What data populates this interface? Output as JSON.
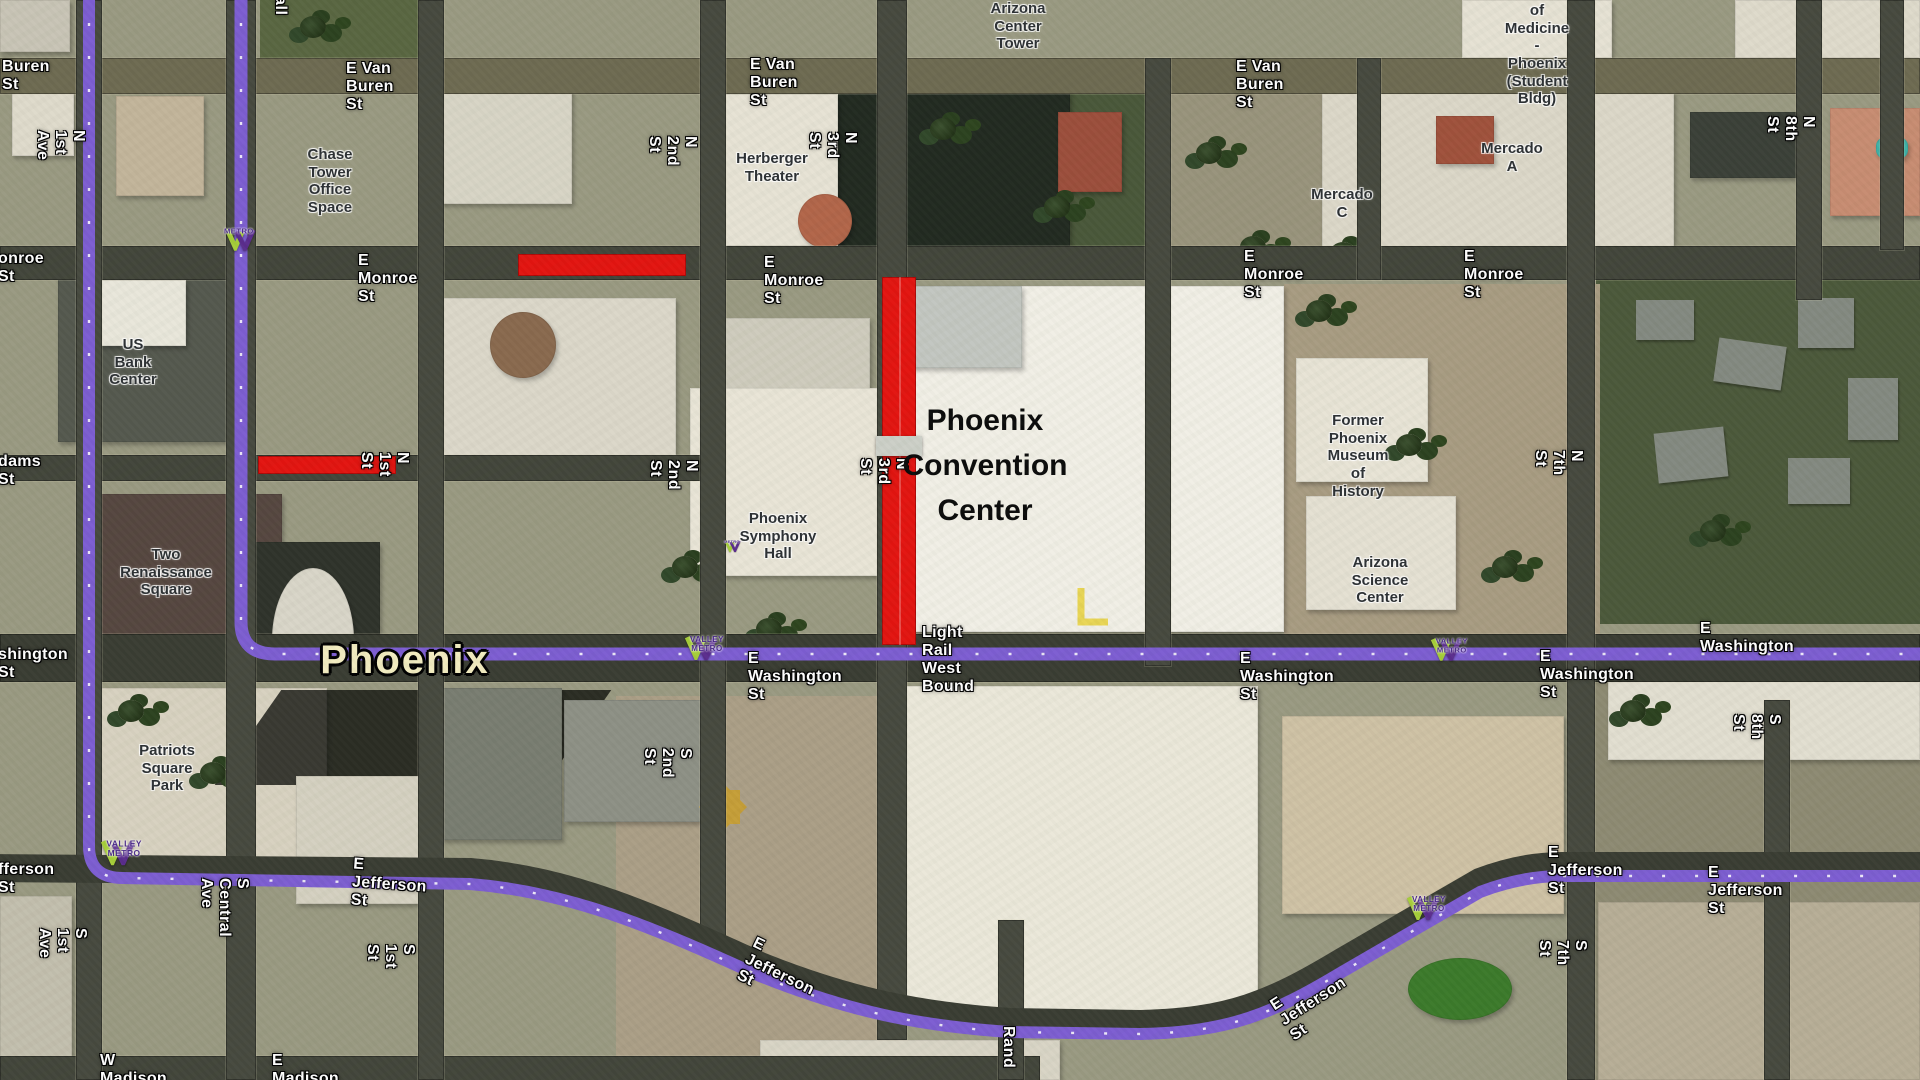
{
  "map": {
    "title_city_label": "Phoenix",
    "convention_center_label": "Phoenix\nConvention\nCenter",
    "colors": {
      "light_rail_purple": "#7d5ed2",
      "road_closure_red": "#e31511",
      "city_label_cream": "#f2ecc0",
      "metro_logo_green": "#a6ce39",
      "metro_logo_purple": "#5b2d8e"
    },
    "street_labels": [
      {
        "t": "Buren St",
        "x": 2,
        "y": 58
      },
      {
        "t": "E Van Buren St",
        "x": 346,
        "y": 60
      },
      {
        "t": "E Van Buren St",
        "x": 750,
        "y": 56
      },
      {
        "t": "E Van Buren St",
        "x": 1236,
        "y": 58
      },
      {
        "t": "onroe St",
        "x": -2,
        "y": 250
      },
      {
        "t": "E Monroe St",
        "x": 358,
        "y": 252
      },
      {
        "t": "E Monroe St",
        "x": 764,
        "y": 254
      },
      {
        "t": "E Monroe St",
        "x": 1244,
        "y": 248
      },
      {
        "t": "E Monroe St",
        "x": 1464,
        "y": 248
      },
      {
        "t": "dams St",
        "x": -2,
        "y": 453
      },
      {
        "t": "shington St",
        "x": -2,
        "y": 646
      },
      {
        "t": "E Washington St",
        "x": 748,
        "y": 650
      },
      {
        "t": "E Washington St",
        "x": 1240,
        "y": 650
      },
      {
        "t": "E Washington St",
        "x": 1540,
        "y": 648
      },
      {
        "t": "E Washington",
        "x": 1700,
        "y": 620
      },
      {
        "t": "Light Rail West Bound",
        "x": 922,
        "y": 624
      },
      {
        "t": "fferson St",
        "x": -2,
        "y": 861
      },
      {
        "t": "E Jefferson St",
        "x": 352,
        "y": 858,
        "r": 4
      },
      {
        "t": "E Jefferson St",
        "x": 742,
        "y": 948,
        "r": 26
      },
      {
        "t": "E Jefferson St",
        "x": 1548,
        "y": 844
      },
      {
        "t": "E Jefferson St",
        "x": 1708,
        "y": 864
      },
      {
        "t": "E Jefferson St",
        "x": 1276,
        "y": 975,
        "r": -33
      },
      {
        "t": "W Madison St",
        "x": 100,
        "y": 1052
      },
      {
        "t": "E Madison St",
        "x": 272,
        "y": 1052
      }
    ],
    "vertical_street_labels": [
      {
        "t": "N 1st Ave",
        "x": 87,
        "y": 130,
        "r": 90
      },
      {
        "t": "S 1st Ave",
        "x": 89,
        "y": 928,
        "r": 90
      },
      {
        "t": "S Central Ave",
        "x": 251,
        "y": 878,
        "r": 90
      },
      {
        "t": "N 1st St",
        "x": 411,
        "y": 452,
        "r": 90
      },
      {
        "t": "S 1st St",
        "x": 417,
        "y": 944,
        "r": 90
      },
      {
        "t": "N 2nd St",
        "x": 699,
        "y": 136,
        "r": 90
      },
      {
        "t": "N 2nd St",
        "x": 700,
        "y": 460,
        "r": 90
      },
      {
        "t": "S 2nd St",
        "x": 694,
        "y": 748,
        "r": 90
      },
      {
        "t": "N 3rd St",
        "x": 859,
        "y": 132,
        "r": 90
      },
      {
        "t": "N 3rd St",
        "x": 910,
        "y": 458,
        "r": 90
      },
      {
        "t": "N 7th St",
        "x": 1585,
        "y": 450,
        "r": 90
      },
      {
        "t": "S 7th St",
        "x": 1589,
        "y": 940,
        "r": 90
      },
      {
        "t": "N 8th St",
        "x": 1817,
        "y": 116,
        "r": 90
      },
      {
        "t": "S 8th St",
        "x": 1783,
        "y": 714,
        "r": 90
      },
      {
        "t": "Rand",
        "x": 1017,
        "y": 1026,
        "r": 90
      },
      {
        "t": "all",
        "x": 289,
        "y": -4,
        "r": 90
      }
    ],
    "building_labels": [
      {
        "t": "Chase Tower\nOffice Space",
        "x": 330,
        "y": 146
      },
      {
        "t": "US Bank\nCenter",
        "x": 133,
        "y": 336
      },
      {
        "t": "Herberger\nTheater",
        "x": 772,
        "y": 150
      },
      {
        "t": "Arizona Center\nTower",
        "x": 1018,
        "y": 0
      },
      {
        "t": "of Medicine\n- Phoenix\n(Student Bldg)",
        "x": 1537,
        "y": 2
      },
      {
        "t": "Mercado A",
        "x": 1512,
        "y": 140
      },
      {
        "t": "Mercado C",
        "x": 1342,
        "y": 186
      },
      {
        "t": "Two Renaissance\nSquare",
        "x": 166,
        "y": 546
      },
      {
        "t": "Phoenix\nSymphony\nHall",
        "x": 778,
        "y": 510
      },
      {
        "t": "Former Phoenix\nMuseum of\nHistory",
        "x": 1358,
        "y": 412
      },
      {
        "t": "Arizona Science\nCenter",
        "x": 1380,
        "y": 554
      },
      {
        "t": "Patriots\nSquare Park",
        "x": 167,
        "y": 742
      }
    ],
    "metro_logos": [
      {
        "t": "METRO",
        "x": 224,
        "y": 228,
        "s": 0.95
      },
      {
        "t": "VALLEY METRO",
        "x": 684,
        "y": 636,
        "s": 1
      },
      {
        "t": "VALLEY METRO",
        "x": 1430,
        "y": 638,
        "s": 0.95
      },
      {
        "t": "VALLEY METRO",
        "x": 100,
        "y": 840,
        "s": 1.05
      },
      {
        "t": "VALLEY METRO",
        "x": 1406,
        "y": 896,
        "s": 1
      },
      {
        "t": "METRO",
        "x": 724,
        "y": 540,
        "s": 0.5
      }
    ]
  }
}
